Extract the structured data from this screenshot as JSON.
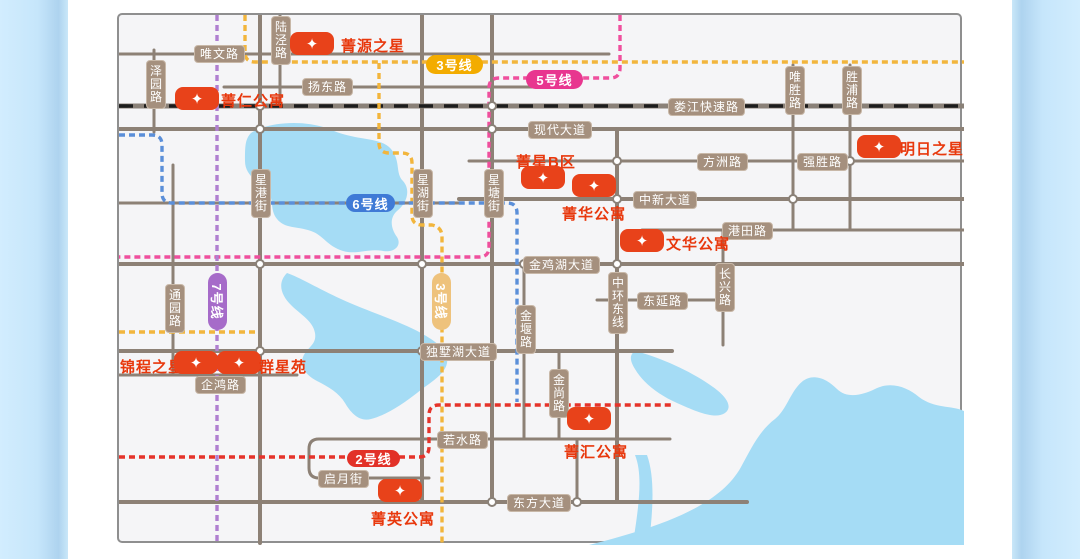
{
  "map": {
    "lines": {
      "line2": {
        "label": "2号线",
        "color": "#e23128"
      },
      "line3": {
        "label": "3号线",
        "color": "#f3ac00"
      },
      "line5": {
        "label": "5号线",
        "color": "#e8368f"
      },
      "line6": {
        "label": "6号线",
        "color": "#3f7ad6"
      },
      "line7": {
        "label": "7号线",
        "color": "#a66bc9"
      }
    },
    "roads": {
      "weiwen": "唯文路",
      "yangdong": "扬东路",
      "loujiang": "娄江快速路",
      "xiandai": "现代大道",
      "fangzhou": "方洲路",
      "qiangsheng": "强胜路",
      "zhongxin": "中新大道",
      "gangtian": "港田路",
      "jinjihu": "金鸡湖大道",
      "dongyan": "东延路",
      "dushuhu": "独墅湖大道",
      "ruoshui": "若水路",
      "qiyue": "启月街",
      "dongfang": "东方大道",
      "qihong": "企鸿路",
      "zeyuan": "泽园路",
      "lujing": "陆泾路",
      "weisheng": "唯胜路",
      "shengpu": "胜浦路",
      "xinggang": "星港街",
      "xinghu": "星湖街",
      "xingtang": "星塘街",
      "tongyuan": "通园路",
      "jinyan": "金堰路",
      "zhonghuan": "中环东线",
      "changxing": "长兴路",
      "jinshang": "金尚路"
    },
    "properties": {
      "jingyuanzhixing": "菁源之星",
      "jingren": "菁仁公寓",
      "mingrizhixing": "明日之星",
      "jingxing_b": "菁星B区",
      "jinghua": "菁华公寓",
      "wenhua": "文华公寓",
      "jincheng": "锦程之星",
      "qunxingyuan": "群星苑",
      "jinghui": "菁汇公寓",
      "jingying": "菁英公寓"
    },
    "colors": {
      "road": "#8d8176",
      "road_label_bg": "#a5907e",
      "marker": "#e8421a",
      "marker_text": "#e8380d",
      "water": "#a5dcf5",
      "railway_dash": "#1c1c1c",
      "side_panel": "#c6e6fb"
    },
    "icons": {
      "marker_star": "✦"
    }
  }
}
